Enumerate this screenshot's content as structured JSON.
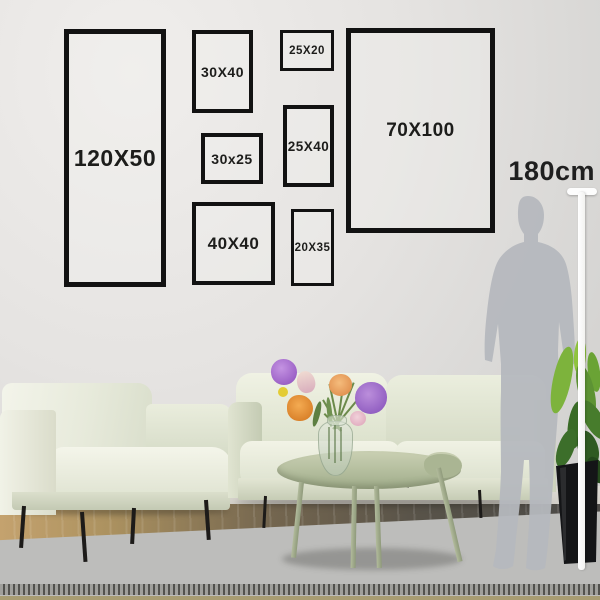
{
  "scene": {
    "description": "Gallery wall picture-frame size guide above a sage-green living room sofa with a 180cm human silhouette for scale",
    "height_label": "180cm"
  },
  "frames": [
    {
      "id": "120x50",
      "label": "120X50"
    },
    {
      "id": "30x40",
      "label": "30X40"
    },
    {
      "id": "25x20",
      "label": "25X20"
    },
    {
      "id": "30x25",
      "label": "30x25"
    },
    {
      "id": "25x40",
      "label": "25X40"
    },
    {
      "id": "70x100",
      "label": "70X100"
    },
    {
      "id": "40x40",
      "label": "40X40"
    },
    {
      "id": "20x35",
      "label": "20X35"
    }
  ],
  "colors": {
    "frame_border": "#121212",
    "label_text": "#1d1d1b",
    "wall": "#e5e3e1",
    "sofa": "#e7ead9",
    "table": "#b3bd9d",
    "rug": "#bdbdbb",
    "silhouette": "#b5b8be",
    "measure_line": "#ffffff",
    "plant_green": "#6aa335",
    "flower_purple": "#9a5fc5",
    "flower_orange": "#e8913c",
    "flower_pink": "#e8b8c8",
    "wood_floor": "#ac9260"
  }
}
